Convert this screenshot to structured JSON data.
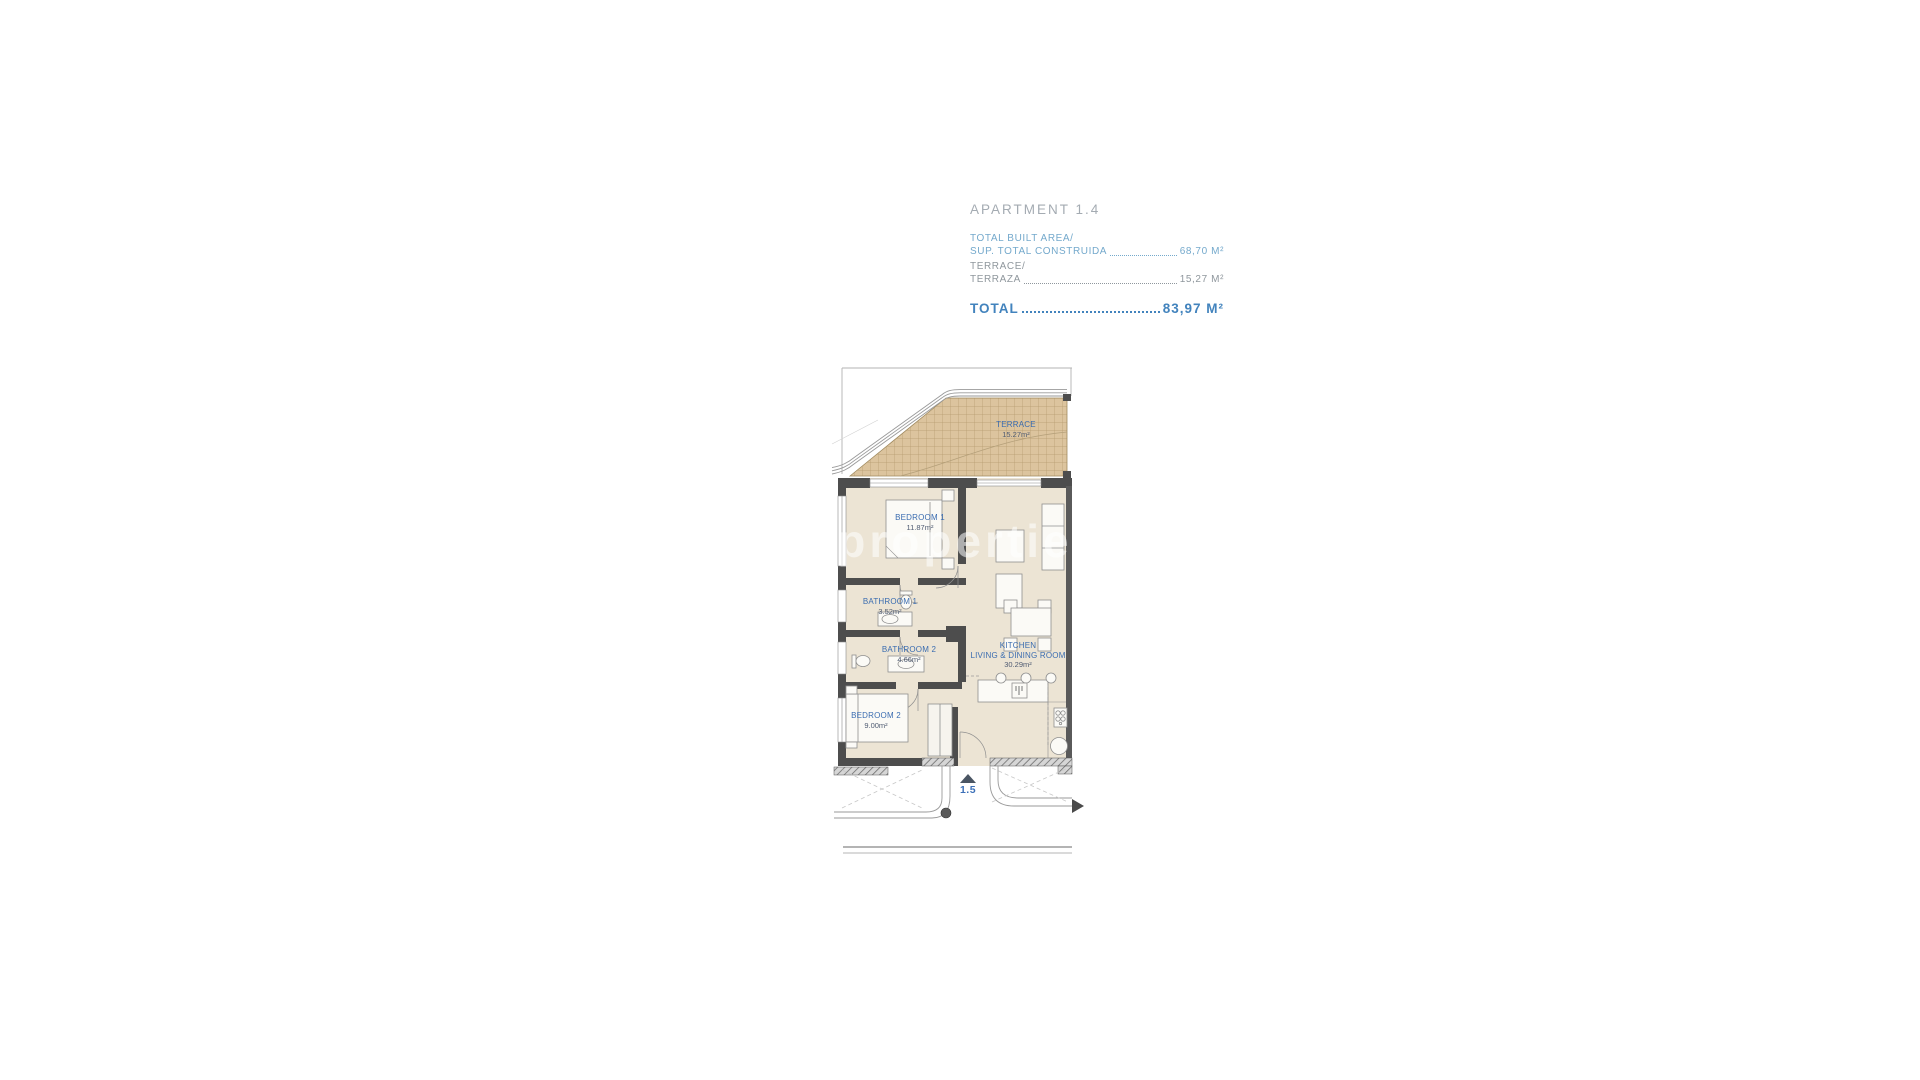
{
  "header": {
    "title": "APARTMENT 1.4",
    "built_area": {
      "line1": "TOTAL BUILT AREA/",
      "line2": "SUP. TOTAL CONSTRUIDA",
      "value": "68,70 M²"
    },
    "terrace_area": {
      "line1": "TERRACE/",
      "line2": "TERRAZA",
      "value": "15,27 M²"
    },
    "total": {
      "label": "TOTAL",
      "value": "83,97 M²"
    }
  },
  "plan": {
    "watermark": "itecproperties",
    "entrance": {
      "label": "1.5"
    },
    "rooms": [
      {
        "name": "TERRACE",
        "area": "15.27m²"
      },
      {
        "name": "BEDROOM 1",
        "area": "11.87m²"
      },
      {
        "name": "BATHROOM 1",
        "area": "3.52m²"
      },
      {
        "name": "BATHROOM 2",
        "area": "4.66m²"
      },
      {
        "name": "BEDROOM 2",
        "area": "9.00m²"
      },
      {
        "name": "KITCHEN",
        "name2": "LIVING & DINING ROOM",
        "area": "30.29m²"
      }
    ]
  },
  "colors": {
    "accent_blue": "#4283bd",
    "light_blue": "#74a9cc",
    "gray_text": "#8f979d",
    "wall": "#4d4d4d",
    "floor": "#ece4d4",
    "terrace": "#dcc49e",
    "room_label_blue": "#3a6cb0"
  }
}
